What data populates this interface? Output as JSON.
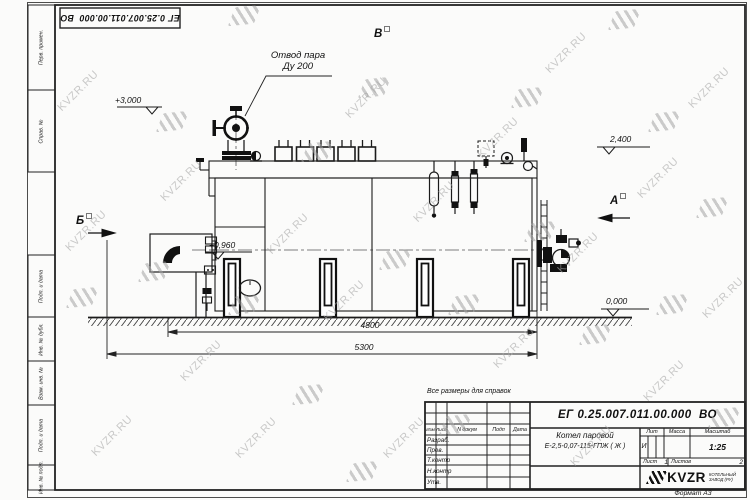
{
  "watermark": {
    "text": "KVZR.RU",
    "items": [
      [
        52,
        85,
        "t"
      ],
      [
        86,
        430,
        "t"
      ],
      [
        155,
        175,
        "t"
      ],
      [
        175,
        355,
        "t"
      ],
      [
        262,
        228,
        "t"
      ],
      [
        230,
        432,
        "t"
      ],
      [
        340,
        92,
        "t"
      ],
      [
        318,
        295,
        "t"
      ],
      [
        408,
        196,
        "t"
      ],
      [
        378,
        432,
        "t"
      ],
      [
        472,
        132,
        "t"
      ],
      [
        488,
        342,
        "t"
      ],
      [
        540,
        47,
        "t"
      ],
      [
        552,
        247,
        "t"
      ],
      [
        565,
        440,
        "t"
      ],
      [
        632,
        172,
        "t"
      ],
      [
        638,
        375,
        "t"
      ],
      [
        683,
        82,
        "t"
      ],
      [
        697,
        292,
        "t"
      ],
      [
        60,
        225,
        "t"
      ],
      [
        232,
        6,
        "l"
      ],
      [
        160,
        112,
        "l"
      ],
      [
        70,
        288,
        "l"
      ],
      [
        142,
        262,
        "l"
      ],
      [
        232,
        295,
        "l"
      ],
      [
        305,
        142,
        "l"
      ],
      [
        296,
        385,
        "l"
      ],
      [
        362,
        78,
        "l"
      ],
      [
        383,
        250,
        "l"
      ],
      [
        452,
        295,
        "l"
      ],
      [
        443,
        415,
        "l"
      ],
      [
        515,
        88,
        "l"
      ],
      [
        528,
        222,
        "l"
      ],
      [
        583,
        325,
        "l"
      ],
      [
        612,
        10,
        "l"
      ],
      [
        652,
        112,
        "l"
      ],
      [
        660,
        295,
        "l"
      ],
      [
        700,
        198,
        "l"
      ],
      [
        712,
        408,
        "l"
      ],
      [
        350,
        462,
        "l"
      ]
    ]
  },
  "frame": {
    "columns": [
      "Перв. примен.",
      "Справ. №",
      "Подп. и дата",
      "Инв. № дубл.",
      "Взам. инв. №",
      "Подп. и дата",
      "Инв. № подл."
    ]
  },
  "drawing": {
    "steam_outlet": {
      "line1": "Отвод пара",
      "line2": "Ду 200"
    },
    "elevations": {
      "valve_top": "+3,000",
      "rear_top": "2,400",
      "front_mid": "+0,960",
      "ground": "0,000"
    },
    "views": {
      "left": "Б",
      "right": "А",
      "top": "В"
    },
    "dims": {
      "boiler_length": "4800",
      "overall_length": "5300"
    }
  },
  "note": "Все размеры для справок",
  "title_block": {
    "designation": "ЕГ 0.25.007.011.00.000  ВО",
    "product_name_line1": "Котел паровой",
    "product_name_line2": "Е-2,5-0,07-115-ГПЖ ( Ж )",
    "cols": {
      "izm": "Изм",
      "list": "Лист",
      "ndoc": "N докум",
      "podp": "Подп",
      "data": "Дата"
    },
    "rows": {
      "razrab": "Разраб.",
      "prov": "Пров.",
      "tkontr": "Т.контр",
      "nkontr": "Н.контр",
      "utv": "Утв."
    },
    "lit": {
      "label": "Лит",
      "value": "И"
    },
    "mass": {
      "label": "Масса"
    },
    "scale": {
      "label": "Масштаб",
      "value": "1:25"
    },
    "sheet": {
      "label": "Лист",
      "value": "1"
    },
    "sheets": {
      "label": "Листов",
      "value": "2"
    },
    "logo": {
      "name": "KVZR",
      "sub1": "КОТЕЛЬНЫЙ",
      "sub2": "ЗАВОД (РУ)"
    },
    "format": "Формат А3"
  }
}
